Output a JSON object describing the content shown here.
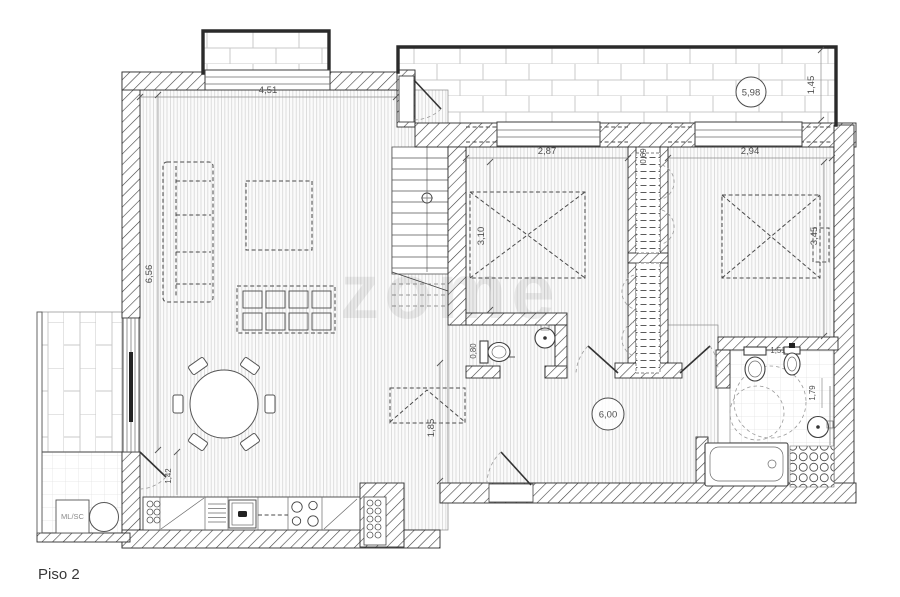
{
  "plan": {
    "title": "Piso 2",
    "watermark": "zome",
    "rooms": {
      "laundry": "ML/SC"
    },
    "area_badges": {
      "terrace": "5,98",
      "hall": "6,00"
    },
    "dims": {
      "living_width": "4,51",
      "living_length": "6,56",
      "terrace_depth": "1,45",
      "bed1_width": "2,87",
      "bed1_length": "3,10",
      "bed2_width": "2,94",
      "bed2_length": "3,45",
      "closet_depth": "0,69",
      "wc_width": "0,80",
      "bath_width": "1,51",
      "bath_length": "1,79",
      "stair_landing": "1,85",
      "kitchen_clear": "1,42"
    },
    "colors": {
      "wall_line": "#3a3a3a",
      "floor_line": "#d6d6d6",
      "brick_line": "#c9c9c9",
      "dim_text": "#4f4f4f",
      "accent_dark": "#2a2a2a"
    }
  }
}
